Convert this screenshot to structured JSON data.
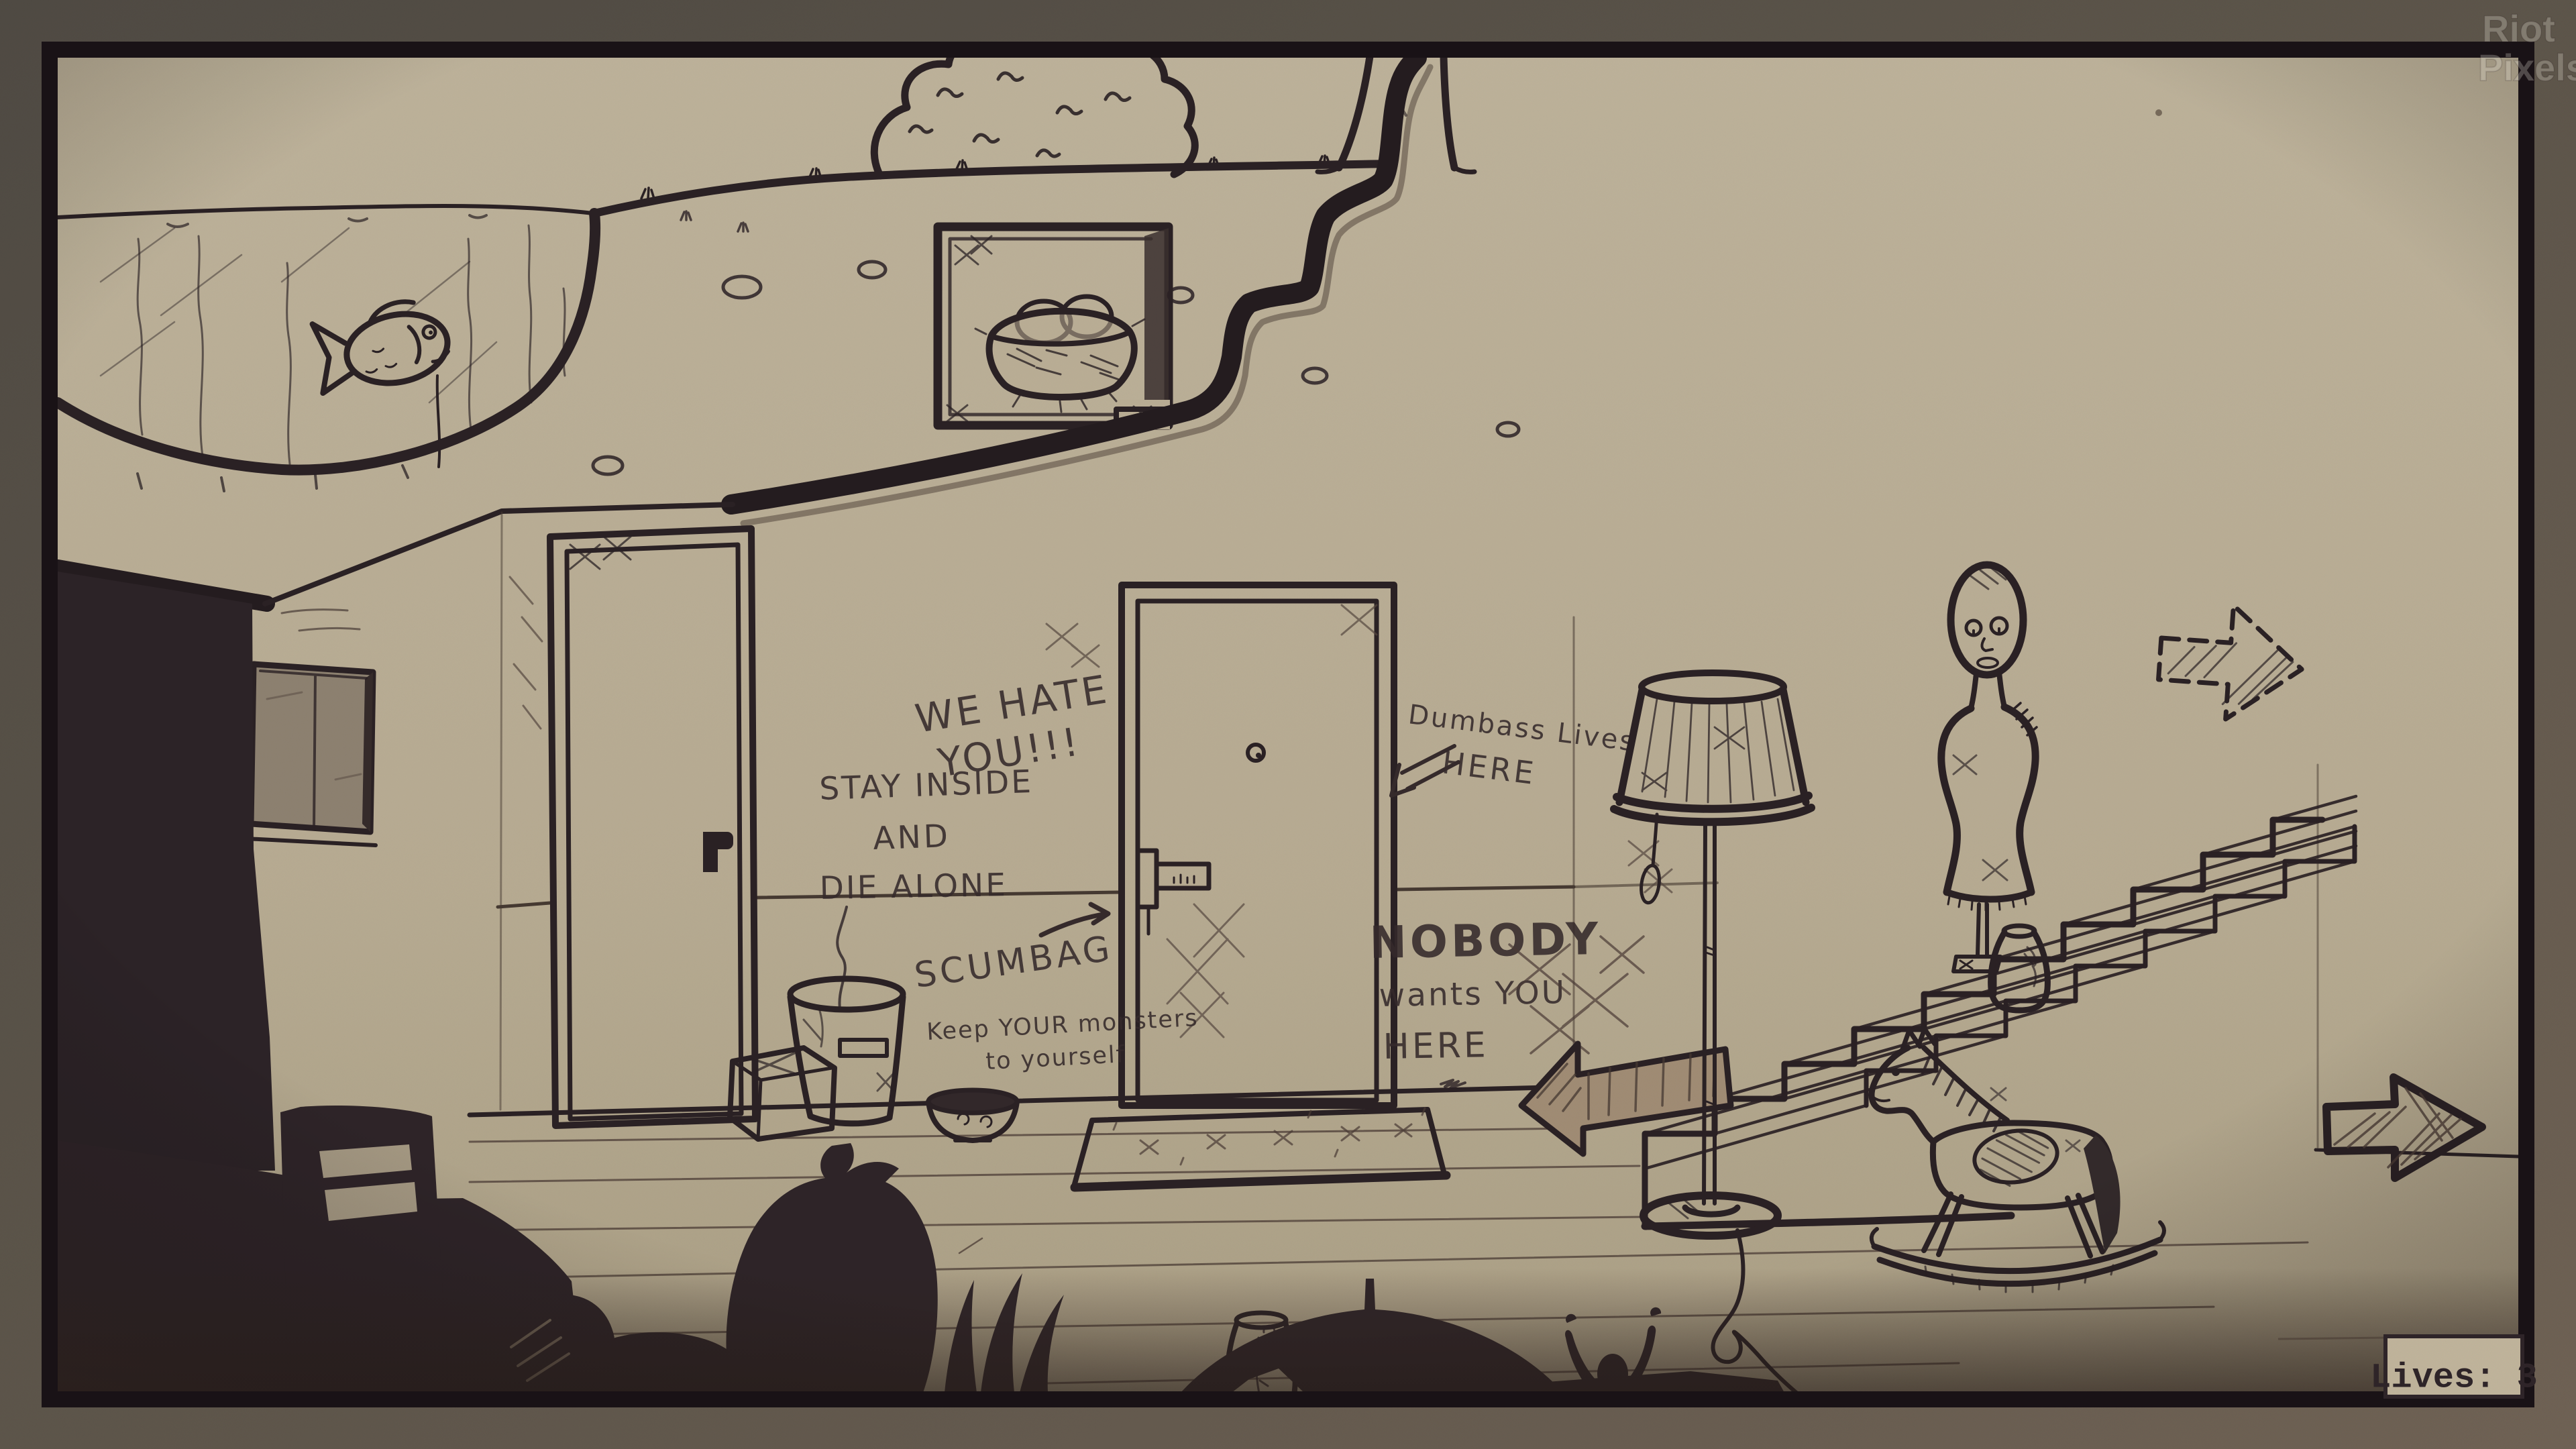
{
  "hud": {
    "lives": "Lives: 3"
  },
  "watermark": {
    "line1": "Riot",
    "line2": "Pixels"
  },
  "graffiti": {
    "we_hate": "WE HATE",
    "you_excl": "YOU!!!",
    "stay_inside": "STAY INSIDE",
    "and_word": "AND",
    "die_alone": "DIE ALONE",
    "scumbag": "SCUMBAG",
    "keep_monsters": "Keep YOUR monsters",
    "to_yourself": "to yourself",
    "dumbass_lives": "Dumbass Lives",
    "here_top": "HERE",
    "nobody": "NOBODY",
    "wants_you": "wants YOU",
    "here_bottom": "HERE"
  },
  "icons": {
    "exit_arrow": "arrow-right-hatched",
    "hint_arrow": "arrow-right-dashed",
    "fallen_arrow": "arrow-left-fallen",
    "scumbag_arrow": "arrow-up-right-scribble",
    "dumbass_arrow": "arrow-left-scribble"
  },
  "colors": {
    "paper": "#b9ad94",
    "ink": "#2a2124",
    "shadow": "#2e2428",
    "frame_outer_dark": "#4f4a43",
    "frame_outer_light": "#6f6254",
    "frame_inner": "#191216",
    "window_glass": "#8d8170",
    "hud_bg": "#c0b49b"
  }
}
